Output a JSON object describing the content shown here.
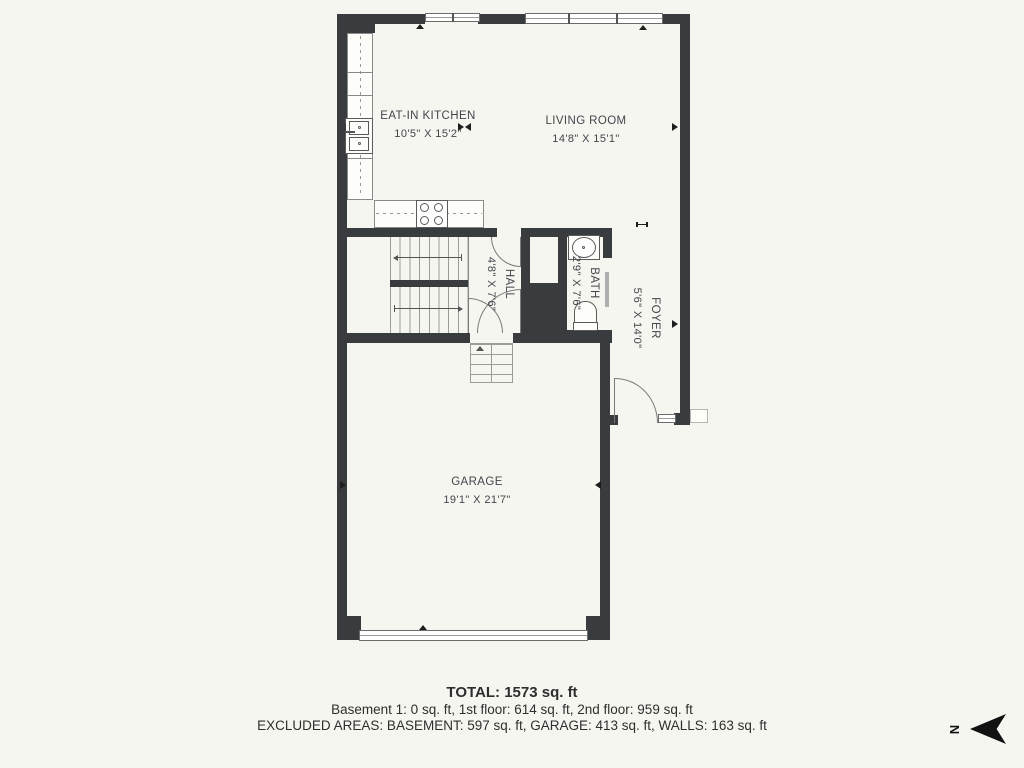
{
  "floorplan": {
    "rooms": [
      {
        "name": "EAT-IN KITCHEN",
        "dims": "10'5\" X 15'2\""
      },
      {
        "name": "LIVING ROOM",
        "dims": "14'8\" X 15'1\""
      },
      {
        "name": "HALL",
        "dims": "4'8\" X 7'6\""
      },
      {
        "name": "BATH",
        "dims": "2'9\" X 7'6\""
      },
      {
        "name": "FOYER",
        "dims": "5'6\" X 14'0\""
      },
      {
        "name": "GARAGE",
        "dims": "19'1\" X 21'7\""
      }
    ],
    "compass_label": "N",
    "colors": {
      "wall": "#393C3E",
      "background": "#F6F6F1",
      "lines": "#8A8A8A"
    }
  },
  "summary": {
    "total": "TOTAL: 1573 sq. ft",
    "floors": "Basement 1: 0 sq. ft, 1st floor: 614 sq. ft, 2nd floor: 959 sq. ft",
    "excluded": "EXCLUDED AREAS: BASEMENT: 597 sq. ft, GARAGE: 413 sq. ft, WALLS: 163 sq. ft"
  }
}
